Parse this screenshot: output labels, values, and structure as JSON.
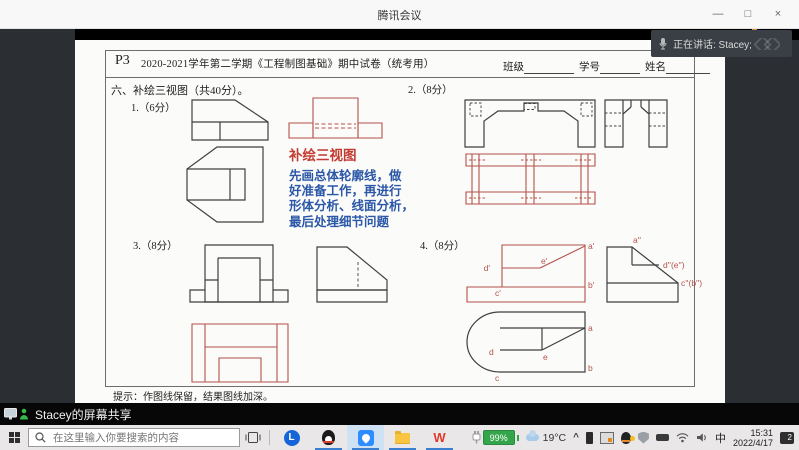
{
  "window": {
    "title": "腾讯会议",
    "minimize": "—",
    "restore": "□",
    "close": "×"
  },
  "toast": {
    "speaking": "正在讲话: Stacey;"
  },
  "share": {
    "label": "Stacey的屏幕共享"
  },
  "paper": {
    "code": "P3",
    "title": "2020-2021学年第二学期《工程制图基础》期中试卷（统考用）",
    "fields": [
      "班级",
      "学号",
      "姓名"
    ],
    "section": "六、补绘三视图（共40分）。",
    "p1": "1.（6分）",
    "p2": "2.（8分）",
    "p3": "3.（8分）",
    "p4": "4.（8分）",
    "annotation": {
      "title": "补绘三视图",
      "lines": [
        "先画总体轮廓线，做",
        "好准备工作，再进行",
        "形体分析、线面分析，",
        "最后处理细节问题"
      ]
    },
    "hint": "提示：作图线保留，结果图线加深。",
    "labels": {
      "af": "a'",
      "ef": "e'",
      "df": "d'",
      "bf": "b'",
      "cf": "c'",
      "as2": "a''",
      "des2": "d''(e'')",
      "cbs2": "c''(b'')",
      "a": "a",
      "b": "b",
      "c": "c",
      "d": "d",
      "e": "e"
    }
  },
  "taskbar": {
    "search_placeholder": "在这里输入你要搜索的内容",
    "browser_glyph": "L",
    "wps_glyph": "W",
    "battery": "99%",
    "temp": "19°C",
    "chevron": "^",
    "ime": "中",
    "time": "15:31",
    "date": "2022/4/17",
    "badge": "2"
  },
  "colors": {
    "pen_red": "#b5514a",
    "pen_black": "#3f3f3f",
    "note_blue": "#2b57a7",
    "battery_green": "#35a54b",
    "running_underline": "#3b7fd0"
  }
}
